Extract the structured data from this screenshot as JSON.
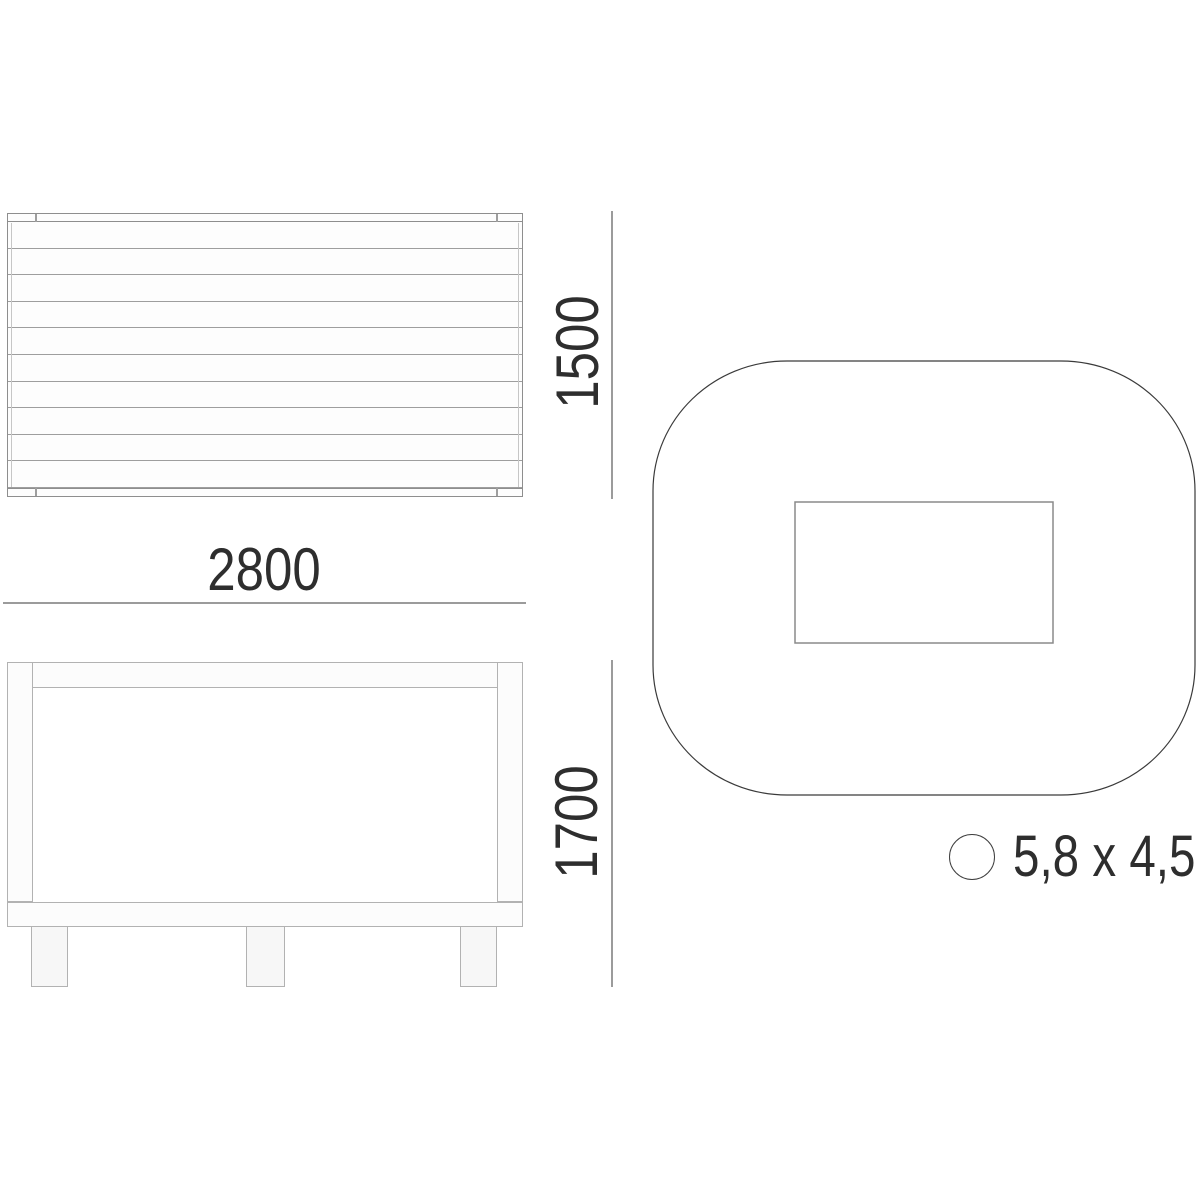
{
  "drawing": {
    "kind": "furniture technical drawing, three orthographic views",
    "dimensions": {
      "width_label": "2800",
      "height_label": "1500",
      "depth_label": "1700",
      "footprint_label": "5,8 x 4,5"
    },
    "top_view": {
      "slat_count": 10
    },
    "front_view": {
      "leg_count": 3
    },
    "colors": {
      "background": "#ffffff",
      "dimension_line": "#9b9b9b",
      "dimension_text": "#2e2e2e",
      "outline_light": "#b2b2b2",
      "outline_medium": "#8e8e8e",
      "outline_soft": "#9e9e9e",
      "outline_dark": "#3f3f3f"
    }
  }
}
